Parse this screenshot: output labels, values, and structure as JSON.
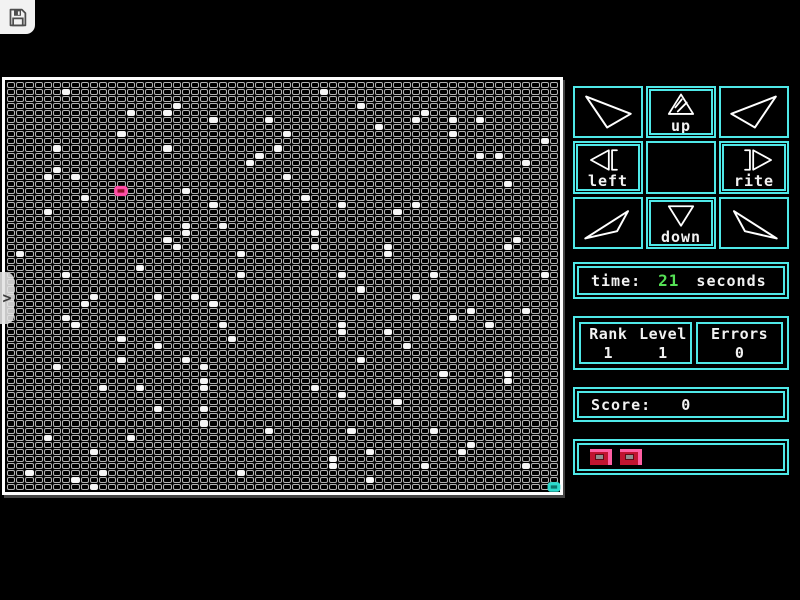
{
  "colors": {
    "cyan": "#4fe8e8",
    "green": "#55e055",
    "white_text": "#f2f2f2",
    "cell_border": "#b3b3b3",
    "dot_fill": "#f5f5f5",
    "life_pink": "#ff5fa2",
    "life_red": "#c01430"
  },
  "toolbar": {
    "save_icon": "floppy-disk"
  },
  "drawer_toggle": {
    "chevron": ">"
  },
  "board": {
    "cols": 60,
    "rows": 58,
    "player": {
      "col": 12,
      "row": 15
    },
    "goal": {
      "col": 59,
      "row": 57
    },
    "dots": [
      [
        6,
        1
      ],
      [
        18,
        3
      ],
      [
        13,
        4
      ],
      [
        17,
        4
      ],
      [
        22,
        5
      ],
      [
        28,
        5
      ],
      [
        12,
        7
      ],
      [
        5,
        9
      ],
      [
        17,
        9
      ],
      [
        29,
        9
      ],
      [
        27,
        10
      ],
      [
        26,
        11
      ],
      [
        5,
        12
      ],
      [
        4,
        13
      ],
      [
        7,
        13
      ],
      [
        30,
        13
      ],
      [
        19,
        15
      ],
      [
        8,
        16
      ],
      [
        22,
        17
      ],
      [
        4,
        18
      ],
      [
        23,
        20
      ],
      [
        19,
        20
      ],
      [
        19,
        21
      ],
      [
        17,
        22
      ],
      [
        18,
        23
      ],
      [
        1,
        24
      ],
      [
        25,
        24
      ],
      [
        14,
        26
      ],
      [
        6,
        27
      ],
      [
        25,
        27
      ],
      [
        34,
        1
      ],
      [
        38,
        3
      ],
      [
        45,
        4
      ],
      [
        44,
        5
      ],
      [
        48,
        5
      ],
      [
        51,
        5
      ],
      [
        40,
        6
      ],
      [
        30,
        7
      ],
      [
        48,
        7
      ],
      [
        58,
        8
      ],
      [
        53,
        10
      ],
      [
        51,
        10
      ],
      [
        56,
        11
      ],
      [
        54,
        14
      ],
      [
        32,
        16
      ],
      [
        36,
        17
      ],
      [
        44,
        17
      ],
      [
        42,
        18
      ],
      [
        33,
        21
      ],
      [
        55,
        22
      ],
      [
        33,
        23
      ],
      [
        41,
        23
      ],
      [
        41,
        24
      ],
      [
        54,
        23
      ],
      [
        36,
        27
      ],
      [
        46,
        27
      ],
      [
        58,
        27
      ],
      [
        38,
        29
      ],
      [
        16,
        30
      ],
      [
        9,
        30
      ],
      [
        20,
        30
      ],
      [
        8,
        31
      ],
      [
        22,
        31
      ],
      [
        6,
        33
      ],
      [
        7,
        34
      ],
      [
        23,
        34
      ],
      [
        12,
        36
      ],
      [
        24,
        36
      ],
      [
        16,
        37
      ],
      [
        12,
        39
      ],
      [
        19,
        39
      ],
      [
        21,
        40
      ],
      [
        5,
        40
      ],
      [
        21,
        42
      ],
      [
        10,
        43
      ],
      [
        14,
        43
      ],
      [
        21,
        43
      ],
      [
        16,
        46
      ],
      [
        21,
        46
      ],
      [
        21,
        48
      ],
      [
        28,
        49
      ],
      [
        4,
        50
      ],
      [
        13,
        50
      ],
      [
        9,
        52
      ],
      [
        2,
        55
      ],
      [
        10,
        55
      ],
      [
        25,
        55
      ],
      [
        7,
        56
      ],
      [
        9,
        57
      ],
      [
        44,
        30
      ],
      [
        56,
        32
      ],
      [
        50,
        32
      ],
      [
        48,
        33
      ],
      [
        52,
        34
      ],
      [
        36,
        34
      ],
      [
        36,
        35
      ],
      [
        41,
        35
      ],
      [
        43,
        37
      ],
      [
        38,
        39
      ],
      [
        47,
        41
      ],
      [
        54,
        41
      ],
      [
        33,
        43
      ],
      [
        54,
        42
      ],
      [
        36,
        44
      ],
      [
        42,
        45
      ],
      [
        46,
        49
      ],
      [
        37,
        49
      ],
      [
        50,
        51
      ],
      [
        49,
        52
      ],
      [
        39,
        52
      ],
      [
        35,
        53
      ],
      [
        45,
        54
      ],
      [
        56,
        54
      ],
      [
        35,
        54
      ],
      [
        39,
        56
      ]
    ]
  },
  "dirpad": {
    "buttons": [
      {
        "name": "up-left",
        "icon": "nw",
        "label": ""
      },
      {
        "name": "up",
        "icon": "up",
        "label": "up"
      },
      {
        "name": "up-right",
        "icon": "ne",
        "label": ""
      },
      {
        "name": "left",
        "icon": "left",
        "label": "left"
      },
      {
        "name": "center",
        "icon": "",
        "label": ""
      },
      {
        "name": "right",
        "icon": "right",
        "label": "rite"
      },
      {
        "name": "down-left",
        "icon": "sw",
        "label": ""
      },
      {
        "name": "down",
        "icon": "down",
        "label": "down"
      },
      {
        "name": "down-right",
        "icon": "se",
        "label": ""
      }
    ]
  },
  "panels": {
    "time": {
      "label": "time:",
      "value": "21",
      "unit": "seconds"
    },
    "rank": {
      "label": "Rank",
      "value": "1"
    },
    "level": {
      "label": "Level",
      "value": "1"
    },
    "errors": {
      "label": "Errors",
      "value": "0"
    },
    "score": {
      "label": "Score:",
      "value": "0"
    },
    "lives": {
      "count": 2
    }
  }
}
